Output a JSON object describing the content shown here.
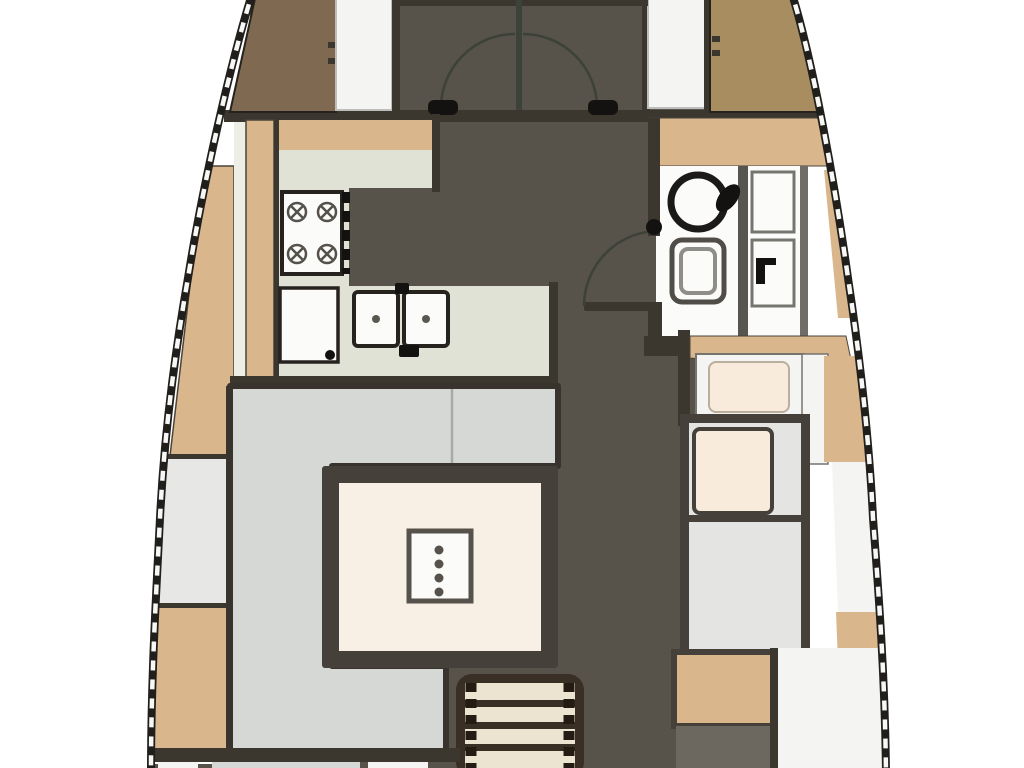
{
  "plan": {
    "type": "yacht-interior-floor-plan",
    "orientation": "bow-up",
    "rooms": [
      "forward-cabin-entry (partial, top)",
      "galley (port side with stove, refrigerator, double sink)",
      "head with round washbasin, marine toilet and separate shower (starboard)",
      "saloon with U-shaped settee and table",
      "navigation station with seats (starboard aft)",
      "companionway-stairs (aft center)",
      "aft-section (partial, bottom)"
    ],
    "fixtures": [
      "double-swing-door",
      "stove-4-burner",
      "refrigerator",
      "double-sink",
      "washbasin",
      "toilet",
      "shower-unit",
      "saloon-table",
      "table-centerpiece",
      "u-settee",
      "nav-seat",
      "chart-seat",
      "stairs-4-steps",
      "head-door"
    ]
  },
  "colors": {
    "background": "#ffffff",
    "hull": "#211f1c",
    "hull_dash": "#f7f7f5",
    "floor": "#57524a",
    "wall": "#3b372f",
    "wood": "#d9b68c",
    "wood_frame": "#46403a",
    "brown_dark": "#7f6a51",
    "brown_medium": "#a88d61",
    "counter": "#e0e2d6",
    "counter_light": "#edeee5",
    "locker_white": "#f4f4f3",
    "fixture_white": "#fbfbfa",
    "sofa": "#d6d8d5",
    "sliver_gray": "#e7e8e6",
    "table_frame": "#45413a",
    "table_cream": "#f8f0e5",
    "seat_cream": "#f8ebdc",
    "desk_gray": "#e4e5e2",
    "stairs_cream": "#ece4d0",
    "stairs_frame": "#392f24",
    "door_arc": "#3c4237",
    "black": "#141210",
    "step_gray": "#6c685f",
    "centerpiece_dot": "#56524b"
  }
}
